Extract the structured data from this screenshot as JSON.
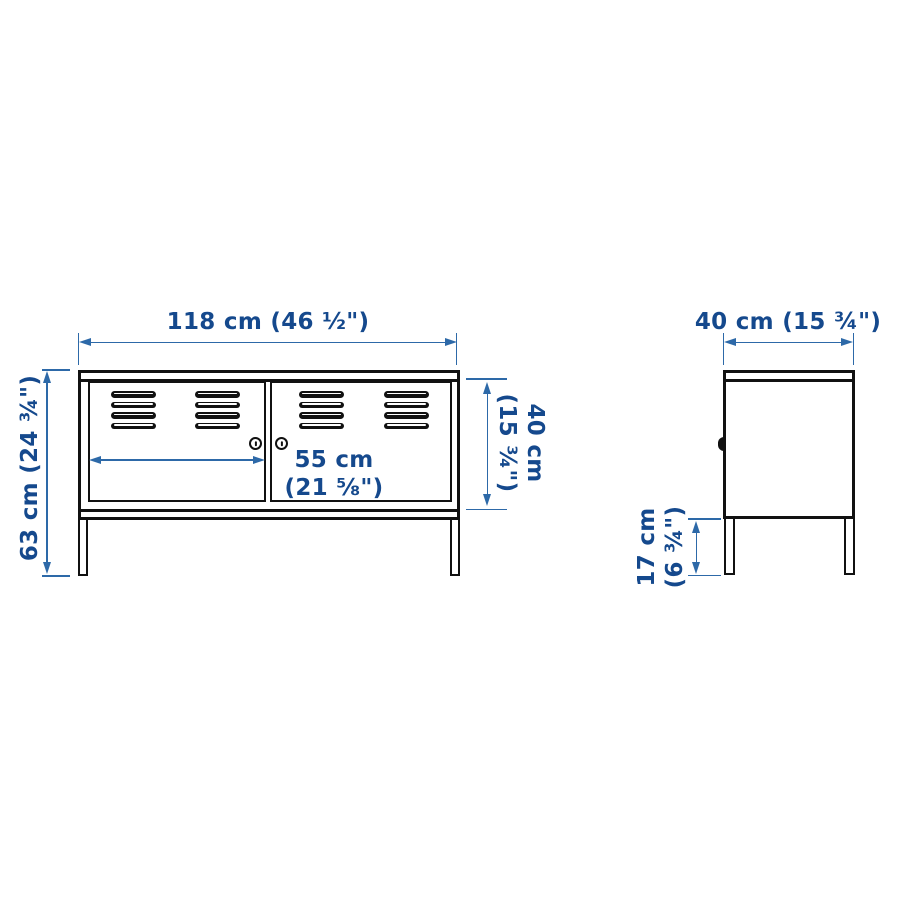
{
  "colors": {
    "dimension_text": "#15498d",
    "dimension_line": "#2d69a8",
    "outline": "#111111",
    "background": "#ffffff"
  },
  "views": {
    "front": {
      "dimensions": {
        "width": "118 cm (46 ½\")",
        "height": "63 cm (24 ¾\")",
        "door_width": [
          "55 cm",
          "(21 ⅝\")"
        ],
        "door_height": [
          "40 cm",
          "(15 ¾\")"
        ]
      }
    },
    "side": {
      "dimensions": {
        "depth": "40 cm (15 ¾\")",
        "leg_height": [
          "17 cm",
          "(6 ¾\")"
        ]
      }
    }
  }
}
